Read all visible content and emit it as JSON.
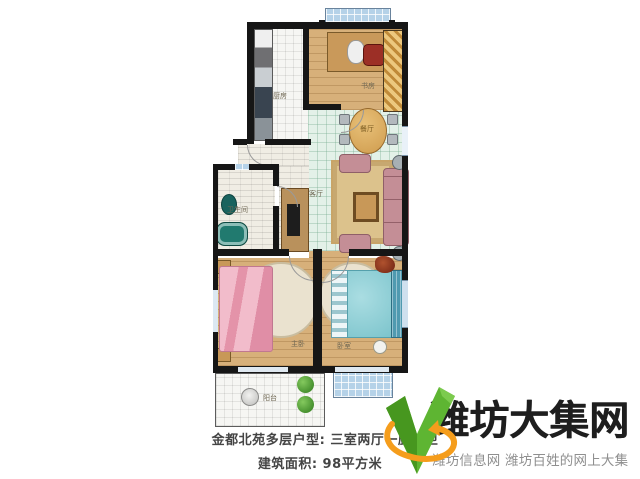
{
  "caption": {
    "line1": "金都北苑多层户型: 三室两厅一厨一卫",
    "line2": "建筑面积: 98平方米"
  },
  "floorplan": {
    "rooms": {
      "kitchen": "厨房",
      "study": "书房",
      "dining": "餐厅",
      "living": "客厅",
      "bathroom": "卫生间",
      "master_bedroom": "主卧",
      "bedroom": "卧室",
      "balcony": "阳台"
    }
  },
  "watermark": {
    "site_name": "潍坊大集网",
    "tagline": "潍坊信息网 潍坊百姓的网上大集",
    "colors": {
      "check_green": "#5eb532",
      "check_green_dark": "#47971f",
      "swoosh_orange": "#f59d1c",
      "name_color": "#1e1e1e",
      "tagline_color": "#8f8f8f"
    }
  }
}
